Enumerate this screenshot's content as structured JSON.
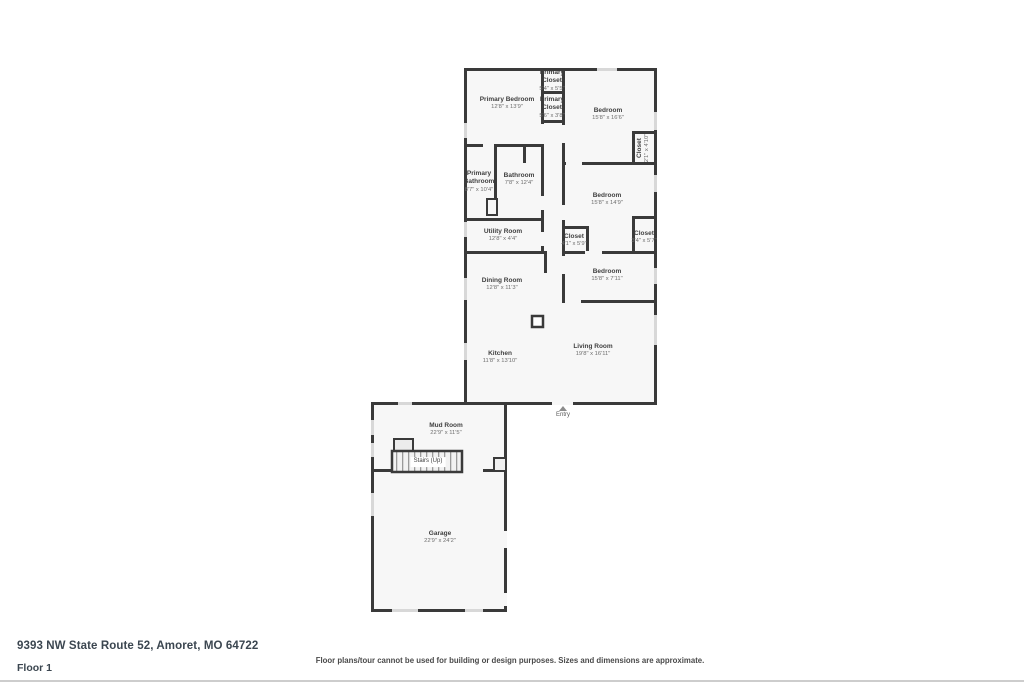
{
  "address": "9393 NW State Route 52, Amoret, MO 64722",
  "floor_label": "Floor 1",
  "disclaimer": "Floor plans/tour cannot be used for building or design purposes. Sizes and dimensions are approximate.",
  "entry_label": "Entry",
  "colors": {
    "wall": "#3a3a3a",
    "room_fill": "#f7f7f7",
    "window": "#d8d8d8"
  },
  "rooms": [
    {
      "name": "Primary Bedroom",
      "dims": "12'8\" x 13'9\""
    },
    {
      "name": "Primary Closet",
      "dims": "5'4\" x 5'5\""
    },
    {
      "name": "Primary Closet",
      "dims": "5'6\" x 3'8\""
    },
    {
      "name": "Bedroom",
      "dims": "15'8\" x 16'6\""
    },
    {
      "name": "Closet",
      "dims": "2'1\" x 4'10\""
    },
    {
      "name": "Primary Bathroom",
      "dims": "8'7\" x 10'4\""
    },
    {
      "name": "Bathroom",
      "dims": "7'8\" x 12'4\""
    },
    {
      "name": "Utility Room",
      "dims": "12'8\" x 4'4\""
    },
    {
      "name": "Bedroom",
      "dims": "15'8\" x 14'9\""
    },
    {
      "name": "Closet",
      "dims": "4'1\" x 5'9\""
    },
    {
      "name": "Closet",
      "dims": "3'4\" x 5'7\""
    },
    {
      "name": "Dining Room",
      "dims": "12'8\" x 11'3\""
    },
    {
      "name": "Bedroom",
      "dims": "15'8\" x 7'11\""
    },
    {
      "name": "Kitchen",
      "dims": "11'8\" x 13'10\""
    },
    {
      "name": "Living Room",
      "dims": "19'8\" x 16'11\""
    },
    {
      "name": "Mud Room",
      "dims": "22'9\" x 11'5\""
    },
    {
      "name": "Stairs (Up)",
      "dims": ""
    },
    {
      "name": "Garage",
      "dims": "22'9\" x 24'2\""
    }
  ]
}
